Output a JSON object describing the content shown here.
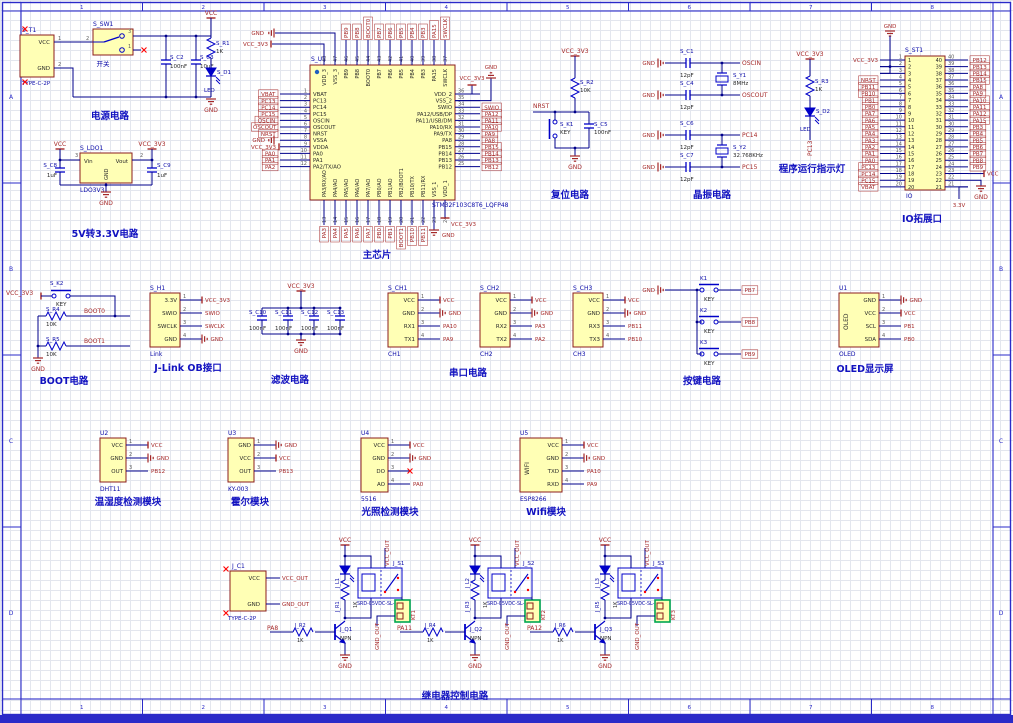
{
  "sheet": {
    "column_labels": [
      "1",
      "2",
      "3",
      "4",
      "5",
      "6",
      "7",
      "8"
    ],
    "row_labels": [
      "A",
      "B",
      "C",
      "D"
    ]
  },
  "colors": {
    "border": "#2a2ac8",
    "grid": "#e3e6ee",
    "wire": "#00008b",
    "symbol": "#0000c8",
    "power": "#a52828",
    "net": "#a52828",
    "designator": "#0a0aa8",
    "caption": "#1212c0",
    "pin_num": "#5a5a5a",
    "pin_name": "#282828",
    "body_fill": "#ffffb5",
    "body_stroke": "#8b1c1c",
    "green": "#00a650",
    "nc_red": "#ff0000"
  },
  "blocks": {
    "power": {
      "caption": "电源电路",
      "components": {
        "t1": {
          "designator": "S_T1",
          "part": "TYPE-C-2P",
          "pins": [
            {
              "num": "1",
              "name": "VCC"
            },
            {
              "num": "2",
              "name": "GND"
            }
          ]
        },
        "sw1": {
          "designator": "S_SW1",
          "part": "开关",
          "pins": {
            "left": "2",
            "top_right": "3",
            "bottom_right": "1"
          }
        },
        "c2": {
          "designator": "S_C2",
          "value": "100nF"
        },
        "c3": {
          "designator": "S_C3",
          "value": "10uF"
        },
        "r1": {
          "designator": "S_R1",
          "value": "1K"
        },
        "d1": {
          "designator": "S_D1",
          "value": "LED"
        }
      },
      "nets": {
        "vcc": "VCC",
        "gnd": "GND"
      }
    },
    "ldo": {
      "caption": "5V转3.3V电路",
      "components": {
        "ldo1": {
          "designator": "S_LDO1",
          "part": "LDO3V3",
          "pin_in": {
            "num": "3",
            "name": "Vin"
          },
          "pin_out": {
            "num": "2",
            "name": "Vout"
          },
          "pin_gnd": {
            "name": "GND"
          }
        },
        "c8": {
          "designator": "S_C8",
          "value": "1uF"
        },
        "c9": {
          "designator": "S_C9",
          "value": "1uF"
        }
      },
      "nets": {
        "vcc": "VCC",
        "v33": "VCC_3V3",
        "gnd": "GND"
      }
    },
    "mcu": {
      "caption": "主芯片",
      "designator": "S_U1",
      "part": "STM32F103C8T6_LQFP48",
      "pins_left": [
        {
          "num": "1",
          "name": "VBAT",
          "net": "VBAT"
        },
        {
          "num": "2",
          "name": "PC13",
          "net": "PC13"
        },
        {
          "num": "3",
          "name": "PC14",
          "net": "PC14"
        },
        {
          "num": "4",
          "name": "PC15",
          "net": "PC15"
        },
        {
          "num": "5",
          "name": "OSCIN",
          "net": "OSCIN"
        },
        {
          "num": "6",
          "name": "OSCOUT",
          "net": "OSCOUT"
        },
        {
          "num": "7",
          "name": "NRST",
          "net": "NRST"
        },
        {
          "num": "8",
          "name": "VSSA",
          "net": "GND"
        },
        {
          "num": "9",
          "name": "VDDA",
          "net": "VCC_3V3"
        },
        {
          "num": "10",
          "name": "PA0",
          "net": "PA0"
        },
        {
          "num": "11",
          "name": "PA1",
          "net": "PA1"
        },
        {
          "num": "12",
          "name": "PA2/TX/AO",
          "net": "PA2"
        }
      ],
      "pins_right": [
        {
          "num": "36",
          "name": "VDD_2",
          "net": "VCC_3V3"
        },
        {
          "num": "35",
          "name": "VSS_2",
          "net": "GND"
        },
        {
          "num": "34",
          "name": "SWIO",
          "net": "SWIO"
        },
        {
          "num": "33",
          "name": "PA12/USB/DP",
          "net": "PA12"
        },
        {
          "num": "32",
          "name": "PA11/USB/DM",
          "net": "PA11"
        },
        {
          "num": "31",
          "name": "PA10/RX",
          "net": "PA10"
        },
        {
          "num": "30",
          "name": "PA9/TX",
          "net": "PA9"
        },
        {
          "num": "29",
          "name": "PA8",
          "net": "PA8"
        },
        {
          "num": "28",
          "name": "PB15",
          "net": "PB15"
        },
        {
          "num": "27",
          "name": "PB14",
          "net": "PB14"
        },
        {
          "num": "26",
          "name": "PB13",
          "net": "PB13"
        },
        {
          "num": "25",
          "name": "PB12",
          "net": "PB12"
        }
      ],
      "pins_top": [
        {
          "num": "48",
          "name": "VDD_3",
          "net": "VCC_3V3"
        },
        {
          "num": "47",
          "name": "VSS_3",
          "net": "GND"
        },
        {
          "num": "46",
          "name": "PB9",
          "net": "PB9"
        },
        {
          "num": "45",
          "name": "PB8",
          "net": "PB8"
        },
        {
          "num": "44",
          "name": "BOOT0",
          "net": "BOOT0"
        },
        {
          "num": "43",
          "name": "PB7",
          "net": "PB7"
        },
        {
          "num": "42",
          "name": "PB6",
          "net": "PB6"
        },
        {
          "num": "41",
          "name": "PB5",
          "net": "PB5"
        },
        {
          "num": "40",
          "name": "PB4",
          "net": "PB4"
        },
        {
          "num": "39",
          "name": "PB3",
          "net": "PB3"
        },
        {
          "num": "38",
          "name": "PA15",
          "net": "PA15"
        },
        {
          "num": "37",
          "name": "SWCLK",
          "net": "SWCLK"
        }
      ],
      "pins_bottom": [
        {
          "num": "13",
          "name": "PA3/RX/AO",
          "net": "PA3"
        },
        {
          "num": "14",
          "name": "PA4/AO",
          "net": "PA4"
        },
        {
          "num": "15",
          "name": "PA5/AO",
          "net": "PA5"
        },
        {
          "num": "16",
          "name": "PA6/AO",
          "net": "PA6"
        },
        {
          "num": "17",
          "name": "PA7/AO",
          "net": "PA7"
        },
        {
          "num": "18",
          "name": "PB0/AO",
          "net": "PB0"
        },
        {
          "num": "19",
          "name": "PB1/AO",
          "net": "PB1"
        },
        {
          "num": "20",
          "name": "PB2/BOOT1",
          "net": "BOOT1"
        },
        {
          "num": "21",
          "name": "PB10/TX",
          "net": "PB10"
        },
        {
          "num": "22",
          "name": "PB11/RX",
          "net": "PB11"
        },
        {
          "num": "23",
          "name": "VSS_1",
          "net": "GND"
        },
        {
          "num": "24",
          "name": "VDD_1",
          "net": "VCC_3V3"
        }
      ]
    },
    "reset": {
      "caption": "复位电路",
      "components": {
        "r2": {
          "designator": "S_R2",
          "value": "10K"
        },
        "k1": {
          "designator": "S_K1",
          "value": "KEY"
        },
        "c5": {
          "designator": "S_C5",
          "value": "100nF"
        }
      },
      "nets": {
        "v33": "VCC_3V3",
        "nrst": "NRST",
        "gnd": "GND"
      }
    },
    "crystal": {
      "caption": "晶振电路",
      "components": {
        "c1": {
          "designator": "S_C1",
          "value": "12pF"
        },
        "c4": {
          "designator": "S_C4",
          "value": "12pF"
        },
        "y1": {
          "designator": "S_Y1",
          "value": "8MHz"
        },
        "c6": {
          "designator": "S_C6",
          "value": "12pF"
        },
        "c7": {
          "designator": "S_C7",
          "value": "12pF"
        },
        "y2": {
          "designator": "S_Y2",
          "value": "32.768KHz"
        }
      },
      "nets": {
        "oscin": "OSCIN",
        "oscout": "OSCOUT",
        "pc14": "PC14",
        "pc15": "PC15",
        "gnd": "GND"
      }
    },
    "runled": {
      "caption": "程序运行指示灯",
      "components": {
        "r3": {
          "designator": "S_R3",
          "value": "1K"
        },
        "d2": {
          "designator": "S_D2",
          "value": "LED"
        }
      },
      "nets": {
        "v33": "VCC_3V3",
        "pc13": "PC13"
      }
    },
    "io": {
      "caption": "IO拓展口",
      "designator": "S_ST1",
      "part": "IO",
      "pins_left": [
        {
          "num": "1",
          "net": "VCC_3V3"
        },
        {
          "num": "2",
          "net": "GND"
        },
        {
          "num": "3",
          "net": ""
        },
        {
          "num": "4",
          "net": "NRST"
        },
        {
          "num": "5",
          "net": "PB11"
        },
        {
          "num": "6",
          "net": "PB10"
        },
        {
          "num": "7",
          "net": "PB1"
        },
        {
          "num": "8",
          "net": "PB0"
        },
        {
          "num": "9",
          "net": "PA7"
        },
        {
          "num": "10",
          "net": "PA6"
        },
        {
          "num": "11",
          "net": "PA5"
        },
        {
          "num": "12",
          "net": "PA4"
        },
        {
          "num": "13",
          "net": "PA3"
        },
        {
          "num": "14",
          "net": "PA2"
        },
        {
          "num": "15",
          "net": "PA1"
        },
        {
          "num": "16",
          "net": "PA0"
        },
        {
          "num": "17",
          "net": "PC13"
        },
        {
          "num": "18",
          "net": "PC14"
        },
        {
          "num": "19",
          "net": "PC15"
        },
        {
          "num": "20",
          "net": "VBAT"
        }
      ],
      "pins_right": [
        {
          "num": "40",
          "net": "PB12"
        },
        {
          "num": "39",
          "net": "PB13"
        },
        {
          "num": "38",
          "net": "PB14"
        },
        {
          "num": "37",
          "net": "PB15"
        },
        {
          "num": "36",
          "net": "PA8"
        },
        {
          "num": "35",
          "net": "PA9"
        },
        {
          "num": "34",
          "net": "PA10"
        },
        {
          "num": "33",
          "net": "PA11"
        },
        {
          "num": "32",
          "net": "PA12"
        },
        {
          "num": "31",
          "net": "PA15"
        },
        {
          "num": "30",
          "net": "PB3"
        },
        {
          "num": "29",
          "net": "PB4"
        },
        {
          "num": "28",
          "net": "PB5"
        },
        {
          "num": "27",
          "net": "PB6"
        },
        {
          "num": "26",
          "net": "PB7"
        },
        {
          "num": "25",
          "net": "PB8"
        },
        {
          "num": "24",
          "net": "PB9"
        },
        {
          "num": "23",
          "net": "VCC"
        },
        {
          "num": "22",
          "net": "GND"
        },
        {
          "num": "21",
          "net": "3.3V"
        }
      ]
    },
    "boot": {
      "caption": "BOOT电路",
      "components": {
        "k2": {
          "designator": "S_K2",
          "value": "KEY"
        },
        "r4": {
          "designator": "S_R4",
          "value": "10K"
        },
        "r5": {
          "designator": "S_R5",
          "value": "10K"
        }
      },
      "nets": {
        "v33": "VCC_3V3",
        "boot0": "BOOT0",
        "boot1": "BOOT1",
        "gnd": "GND"
      }
    },
    "jlink": {
      "caption": "J-Link OB接口",
      "designator": "S_H1",
      "part": "Link",
      "pins": [
        {
          "num": "1",
          "name": "3.3V",
          "net": "VCC_3V3"
        },
        {
          "num": "2",
          "name": "SWIO",
          "net": "SWIO"
        },
        {
          "num": "3",
          "name": "SWCLK",
          "net": "SWCLK"
        },
        {
          "num": "4",
          "name": "GND",
          "net": "GND"
        }
      ]
    },
    "filter": {
      "caption": "滤波电路",
      "components": {
        "c10": {
          "designator": "S_C10",
          "value": "100nF"
        },
        "c11": {
          "designator": "S_C11",
          "value": "100nF"
        },
        "c12": {
          "designator": "S_C12",
          "value": "100nF"
        },
        "c13": {
          "designator": "S_C13",
          "value": "100nF"
        }
      },
      "nets": {
        "v33": "VCC_3V3",
        "gnd": "GND"
      }
    },
    "serial": {
      "caption": "串口电路",
      "modules": [
        {
          "designator": "S_CH1",
          "part": "CH1",
          "pins": [
            {
              "num": "1",
              "name": "VCC",
              "net": "VCC"
            },
            {
              "num": "2",
              "name": "GND",
              "net": "GND"
            },
            {
              "num": "3",
              "name": "RX1",
              "net": "PA10"
            },
            {
              "num": "4",
              "name": "TX1",
              "net": "PA9"
            }
          ]
        },
        {
          "designator": "S_CH2",
          "part": "CH2",
          "pins": [
            {
              "num": "1",
              "name": "VCC",
              "net": "VCC"
            },
            {
              "num": "2",
              "name": "GND",
              "net": "GND"
            },
            {
              "num": "3",
              "name": "RX2",
              "net": "PA3"
            },
            {
              "num": "4",
              "name": "TX2",
              "net": "PA2"
            }
          ]
        },
        {
          "designator": "S_CH3",
          "part": "CH3",
          "pins": [
            {
              "num": "1",
              "name": "VCC",
              "net": "VCC"
            },
            {
              "num": "2",
              "name": "GND",
              "net": "GND"
            },
            {
              "num": "3",
              "name": "RX3",
              "net": "PB11"
            },
            {
              "num": "4",
              "name": "TX3",
              "net": "PB10"
            }
          ]
        }
      ]
    },
    "keys": {
      "caption": "按键电路",
      "nets": {
        "gnd": "GND"
      },
      "keys": [
        {
          "designator": "K1",
          "label": "KEY",
          "net": "PB7"
        },
        {
          "designator": "K2",
          "label": "KEY",
          "net": "PB8"
        },
        {
          "designator": "K3",
          "label": "KEY",
          "net": "PB9"
        }
      ]
    },
    "oled": {
      "caption": "OLED显示屏",
      "designator": "U1",
      "part": "OLED",
      "vert": "OLED",
      "pins": [
        {
          "num": "1",
          "name": "GND",
          "net": "GND"
        },
        {
          "num": "2",
          "name": "VCC",
          "net": "VCC"
        },
        {
          "num": "3",
          "name": "SCL",
          "net": "PB1"
        },
        {
          "num": "4",
          "name": "SDA",
          "net": "PB0"
        }
      ]
    },
    "dht": {
      "caption": "温湿度检测模块",
      "designator": "U2",
      "part": "DHT11",
      "pins": [
        {
          "num": "1",
          "name": "VCC",
          "net": "VCC"
        },
        {
          "num": "2",
          "name": "GND",
          "net": "GND"
        },
        {
          "num": "3",
          "name": "OUT",
          "net": "PB12"
        }
      ]
    },
    "hall": {
      "caption": "霍尔模块",
      "designator": "U3",
      "part": "KY-003",
      "pins": [
        {
          "num": "1",
          "name": "GND",
          "net": "GND"
        },
        {
          "num": "2",
          "name": "VCC",
          "net": "VCC"
        },
        {
          "num": "3",
          "name": "OUT",
          "net": "PB13"
        }
      ]
    },
    "light": {
      "caption": "光照检测模块",
      "designator": "U4",
      "part": "5516",
      "pins": [
        {
          "num": "1",
          "name": "VCC",
          "net": "VCC"
        },
        {
          "num": "2",
          "name": "GND",
          "net": "GND"
        },
        {
          "num": "3",
          "name": "DO",
          "net": ""
        },
        {
          "num": "4",
          "name": "AO",
          "net": "PA0"
        }
      ]
    },
    "wifi": {
      "caption": "Wifi模块",
      "designator": "U5",
      "part": "ESP8266",
      "vert": "WIFI",
      "pins": [
        {
          "num": "1",
          "name": "VCC",
          "net": "VCC"
        },
        {
          "num": "2",
          "name": "GND",
          "net": "GND"
        },
        {
          "num": "3",
          "name": "TXD",
          "net": "PA10"
        },
        {
          "num": "4",
          "name": "RXD",
          "net": "PA9"
        }
      ]
    },
    "relay": {
      "caption": "继电器控制电路",
      "connector": {
        "designator": "J_C1",
        "part": "TYPE-C-2P",
        "pins": [
          {
            "name": "VCC",
            "net": "VCC_OUT"
          },
          {
            "name": "GND",
            "net": "GND_OUT"
          }
        ]
      },
      "channels": [
        {
          "input": "PA8",
          "base_res": {
            "designator": "J_R2",
            "value": "1K"
          },
          "transistor": {
            "designator": "J_Q1",
            "type": "NPN"
          },
          "led_designator": "J_L1",
          "coil_res": {
            "designator": "J_R1",
            "value": "1K"
          },
          "relay": {
            "designator": "J_S1",
            "part": "SRD-05VDC-SL-C"
          },
          "connector_label": "KT1",
          "nets": {
            "vcc": "VCC",
            "vcc_out": "VCC_OUT",
            "gnd_out": "GND_OUT",
            "gnd": "GND"
          }
        },
        {
          "input": "PA11",
          "base_res": {
            "designator": "J_R4",
            "value": "1K"
          },
          "transistor": {
            "designator": "J_Q2",
            "type": "NPN"
          },
          "led_designator": "J_L2",
          "coil_res": {
            "designator": "J_R3",
            "value": "1K"
          },
          "relay": {
            "designator": "J_S2",
            "part": "SRD-05VDC-SL-C"
          },
          "connector_label": "KT2",
          "nets": {
            "vcc": "VCC",
            "vcc_out": "VCC_OUT",
            "gnd_out": "GND_OUT",
            "gnd": "GND"
          }
        },
        {
          "input": "PA12",
          "base_res": {
            "designator": "J_R6",
            "value": "1K"
          },
          "transistor": {
            "designator": "J_Q3",
            "type": "NPN"
          },
          "led_designator": "J_L3",
          "coil_res": {
            "designator": "J_R5",
            "value": "1K"
          },
          "relay": {
            "designator": "J_S3",
            "part": "SRD-05VDC-SL-C"
          },
          "connector_label": "KT3",
          "nets": {
            "vcc": "VCC",
            "vcc_out": "VCC_OUT",
            "gnd_out": "GND_OUT",
            "gnd": "GND"
          }
        }
      ]
    }
  }
}
